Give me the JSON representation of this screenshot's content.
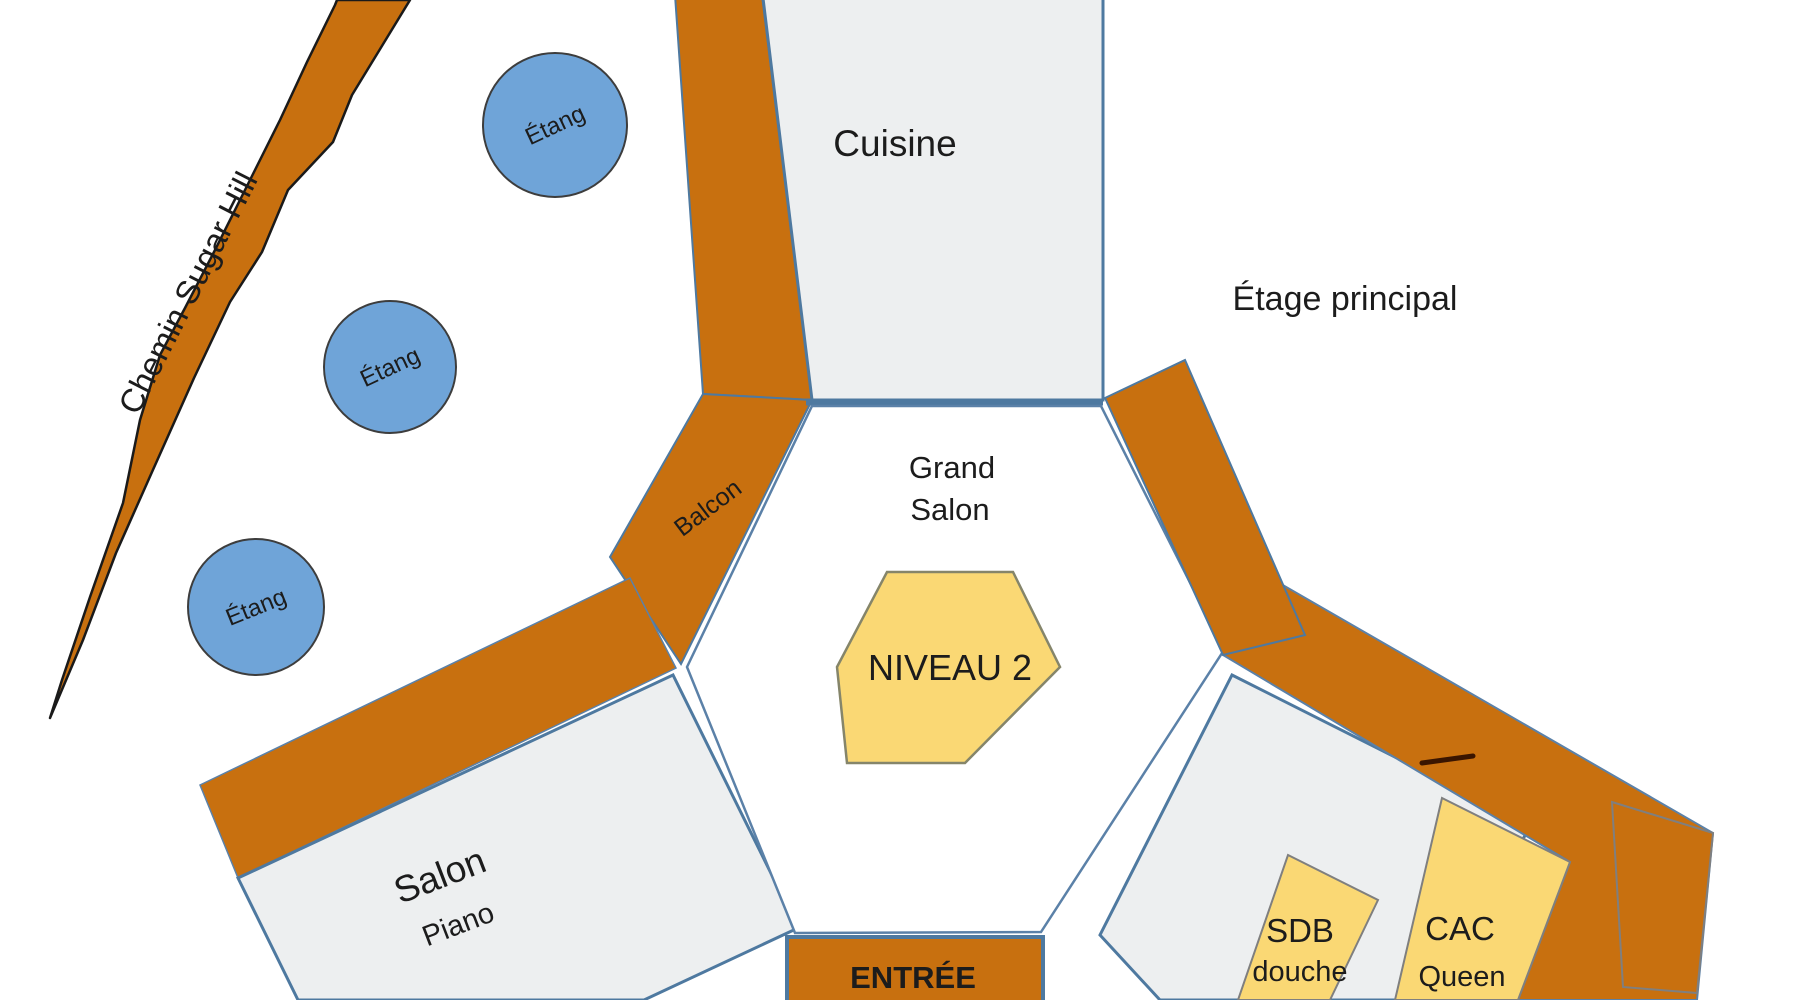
{
  "plan": {
    "floor_label": "Étage principal",
    "road": {
      "label": "Chemin Sugar Hill"
    },
    "ponds": [
      {
        "label": "Étang"
      },
      {
        "label": "Étang"
      },
      {
        "label": "Étang"
      }
    ],
    "rooms": {
      "cuisine": {
        "label": "Cuisine"
      },
      "grand_salon": {
        "line1": "Grand",
        "line2": "Salon"
      },
      "niveau_marker": {
        "label": "NIVEAU 2"
      },
      "balcon": {
        "label": "Balcon"
      },
      "salon": {
        "label": "Salon",
        "sublabel": "Piano"
      },
      "entree": {
        "label": "ENTRÉE"
      },
      "sdb": {
        "label": "SDB",
        "sublabel": "douche"
      },
      "cac": {
        "label": "CAC",
        "sublabel": "Queen"
      }
    },
    "colors": {
      "deck_orange": "#C8700F",
      "pond_blue": "#6FA4D8",
      "room_gray": "#EDEFF0",
      "room_yellow": "#FAD874",
      "wall_blue": "#4E79A0",
      "label_brown": "#5B2D05",
      "entree_text_brown": "#4A2000",
      "road_outline": "#1A1A1A"
    }
  }
}
